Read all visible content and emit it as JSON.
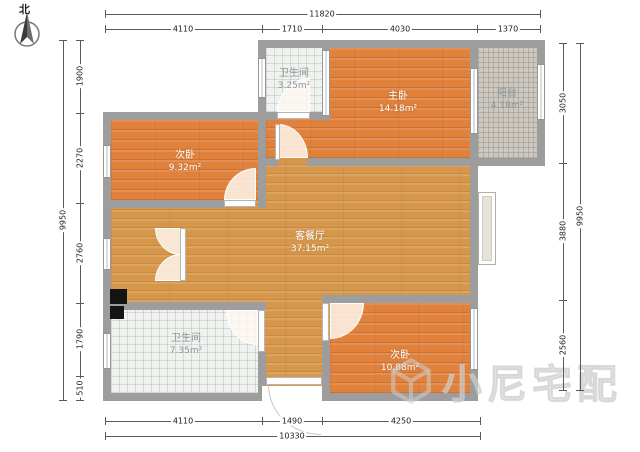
{
  "compass": {
    "label": "北"
  },
  "watermark": {
    "text": "小尼宅配"
  },
  "colors": {
    "wall": "#9d9d9d",
    "bedroom_floor": "#e0813c",
    "living_floor": "#d6974b",
    "bath_tile": "#eff2ee",
    "balcony_tile": "#ccc8c0"
  },
  "rooms": {
    "bathroom_top": {
      "label": "卫生间",
      "area": "3.25m²"
    },
    "master": {
      "label": "主卧",
      "area": "14.18m²"
    },
    "balcony": {
      "label": "阳台",
      "area": "4.18m²"
    },
    "bedroom_left": {
      "label": "次卧",
      "area": "9.32m²"
    },
    "living": {
      "label": "客餐厅",
      "area": "37.15m²"
    },
    "bathroom_bottom": {
      "label": "卫生间",
      "area": "7.35m²"
    },
    "bedroom_bottom": {
      "label": "次卧",
      "area": "10.88m²"
    }
  },
  "dims": {
    "top_total": "11820",
    "top": [
      "4110",
      "1710",
      "4030",
      "1370"
    ],
    "bottom": [
      "4110",
      "1490",
      "4250"
    ],
    "bottom_total": "10330",
    "left": [
      "1900",
      "2270",
      "2760",
      "1790",
      "510"
    ],
    "left_total": "9950",
    "right": [
      "3050",
      "3880",
      "2560"
    ],
    "right_total": "9950"
  }
}
